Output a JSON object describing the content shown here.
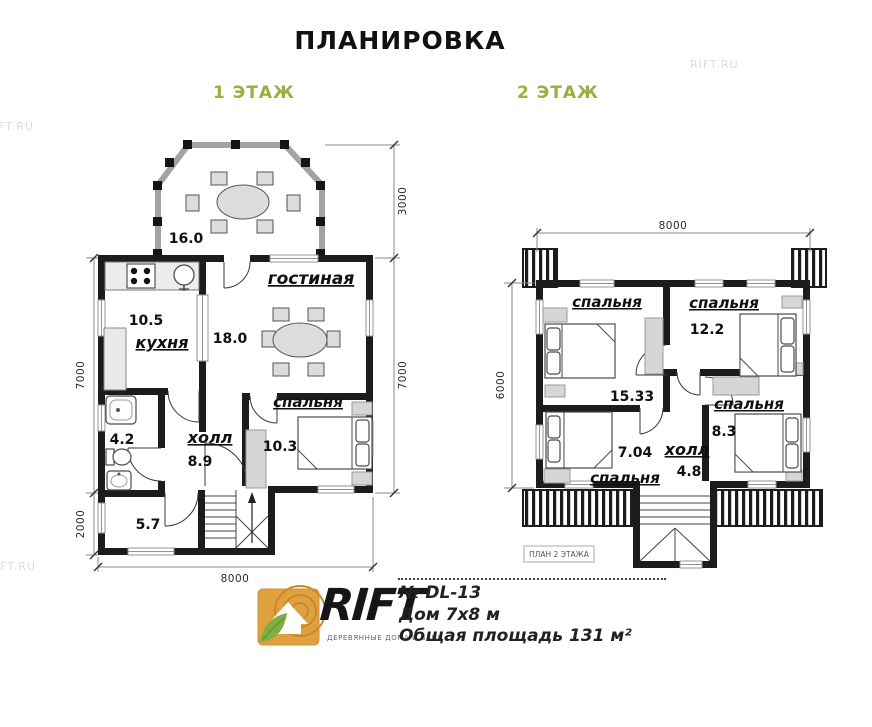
{
  "title": "ПЛАНИРОВКА",
  "floor1": {
    "label": "1 ЭТАЖ",
    "veranda_area": "16.0",
    "living_name": "гостиная",
    "living_area": "18.0",
    "kitchen_name": "кухня",
    "kitchen_area": "10.5",
    "bath_area": "4.2",
    "hall_name": "холл",
    "hall_area": "8.9",
    "bedroom_name": "спальня",
    "bedroom_area": "10.3",
    "entry_area": "5.7",
    "dim_left_main": "7000",
    "dim_left_entry": "2000",
    "dim_right_veranda": "3000",
    "dim_right_main": "7000",
    "dim_bottom": "8000"
  },
  "floor2": {
    "label": "2 ЭТАЖ",
    "bedroom1_name": "спальня",
    "bedroom1_area": "15.33",
    "bedroom2_name": "спальня",
    "bedroom2_area": "12.2",
    "bedroom3_name": "спальня",
    "bedroom3_area": "8.3",
    "bedroom4_name": "спальня",
    "bedroom4_area": "7.04",
    "hall_name": "холл",
    "hall_area": "4.8",
    "plan_caption": "ПЛАН 2 ЭТАЖА",
    "dim_top": "8000",
    "dim_left": "6000"
  },
  "footer": {
    "brand": "RIFT",
    "brand_tagline": "ДЕРЕВЯННЫЕ ДОМА И БАНИ",
    "model": "№ DL-13",
    "house_size": "Дом 7х8 м",
    "total_area": "Общая площадь 131 м²"
  },
  "watermarks": {
    "top_right": "RIFT.RU",
    "left_upper": "IFT.RU",
    "left_lower": "IFT.RU"
  },
  "colors": {
    "accent_green": "#94b23c",
    "wall": "#1c1c1c",
    "logo_orange": "#DFA13F",
    "logo_leaf": "#7CB043"
  }
}
